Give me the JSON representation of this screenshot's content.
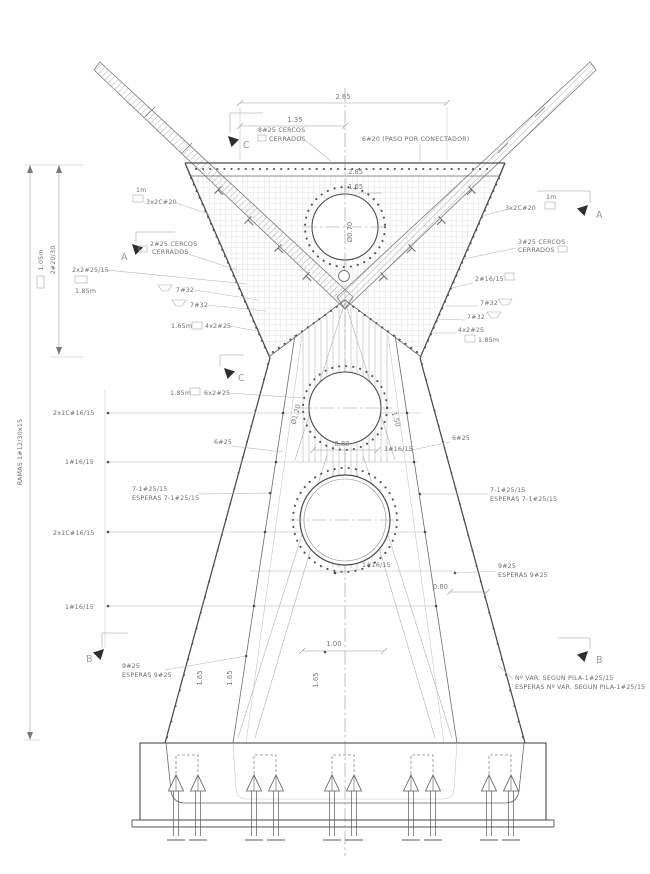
{
  "drawing": {
    "title_hint": "pylon reinforcement elevation",
    "line_color": "#4a4a4a",
    "background": "#ffffff"
  },
  "labels": {
    "dim_top_width": "2.65",
    "dim_top_half": "1.35",
    "stirrups_top_1": "8#25 CERCOS",
    "stirrups_top_2": "CERRADOS",
    "connector": "6#20 (PASO POR CONECTADOR)",
    "dim_head_a": "2.85",
    "dim_head_b": "1.65",
    "duct_top": "Ø0.70",
    "sec_a": "A",
    "sec_b": "B",
    "sec_c": "C",
    "one_m": "1m",
    "left_3x2c20": "3x2C#20",
    "left_cercos_1": "2#25 CERCOS",
    "left_cercos_2": "CERRADOS",
    "left_2x2": "2x2#25/15",
    "len_185": "1.85m",
    "len_165": "1.65m",
    "bar_7_32": "7#32",
    "left_4x2": "4x2#25",
    "left_6x2": "6x2#25",
    "left_2x1c": "2x1C#16/15",
    "bar_6_25": "6#25",
    "bar_1_16": "1#16/15",
    "esp_1": "7-1#25/15",
    "esp_2": "ESPERAS 7-1#25/15",
    "left_9_25_1": "9#25",
    "left_9_25_2": "ESPERAS 9#25",
    "rot_ramas": "RAMAS 1#12/30x15",
    "rot_2_20_30": "2#20/30",
    "rot_105": "1.05m",
    "right_3x2c20": "3x2C#20",
    "right_cercos_1": "3#25 CERCOS",
    "right_cercos_2": "CERRADOS",
    "right_2_16": "2#16/15",
    "right_4x2": "4x2#25",
    "right_var_1": "Nº VAR. SEGUN PILA-1#25/15",
    "right_var_2": "ESPERAS Nº VAR. SEGUN PILA-1#25/15",
    "dim_080": "0.80",
    "dia_120": "Ø1.20",
    "rot_150": "1.50",
    "dim_100": "1.00",
    "rot_165": "1.65"
  }
}
